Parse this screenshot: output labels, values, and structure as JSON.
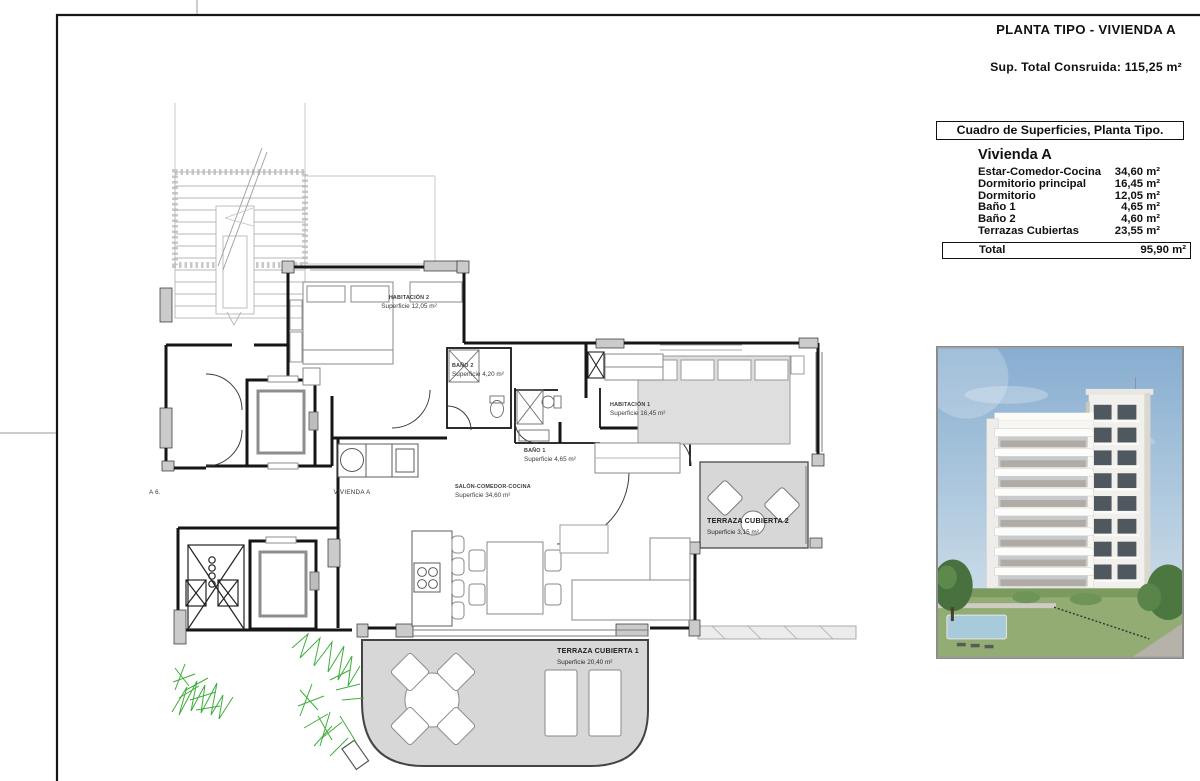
{
  "page": {
    "title": "PLANTA TIPO - VIVIENDA A",
    "built_area": "Sup. Total Consruida: 115,25 m²"
  },
  "surface_table": {
    "header": "Cuadro de Superficies, Planta Tipo.",
    "unit": "Vivienda A",
    "rows": [
      {
        "label": "Estar-Comedor-Cocina",
        "value": "34,60 m²"
      },
      {
        "label": "Dormitorio principal",
        "value": "16,45 m²"
      },
      {
        "label": "Dormitorio",
        "value": "12,05 m²"
      },
      {
        "label": "Baño 1",
        "value": "4,65 m²"
      },
      {
        "label": "Baño 2",
        "value": "4,60 m²"
      },
      {
        "label": "Terrazas Cubiertas",
        "value": "23,55 m²"
      }
    ],
    "total_label": "Total",
    "total_value": "95,90 m²"
  },
  "floor_plan": {
    "labels": {
      "habitacion2": {
        "name": "HABITACIÓN 2",
        "area": "Superficie 12,05 m²"
      },
      "bano2": {
        "name": "BAÑO 2",
        "area": "Superficie 4,20 m²"
      },
      "habitacion1": {
        "name": "HABITACIÓN 1",
        "area": "Superficie 16,45 m²"
      },
      "bano1": {
        "name": "BAÑO 1",
        "area": "Superficie 4,65 m²"
      },
      "salon": {
        "name": "SALÓN-COMEDOR-COCINA",
        "area": "Superficie 34,60 m²"
      },
      "terraza2": {
        "name": "TERRAZA CUBIERTA 2",
        "area": "Superficie 3,15 m²"
      },
      "terraza1": {
        "name": "TERRAZA CUBIERTA 1",
        "area": "Superficie 20,40 m²"
      },
      "vivienda_a": "VIVIENDA A",
      "vivienda_left": "A 6."
    }
  },
  "colors": {
    "wall": "#161616",
    "terrace_fill": "#d7d7d7",
    "pillar_fill": "#cbcbcb",
    "plant_green": "#3fae3c",
    "sky_blue": "#8fb3d3"
  }
}
